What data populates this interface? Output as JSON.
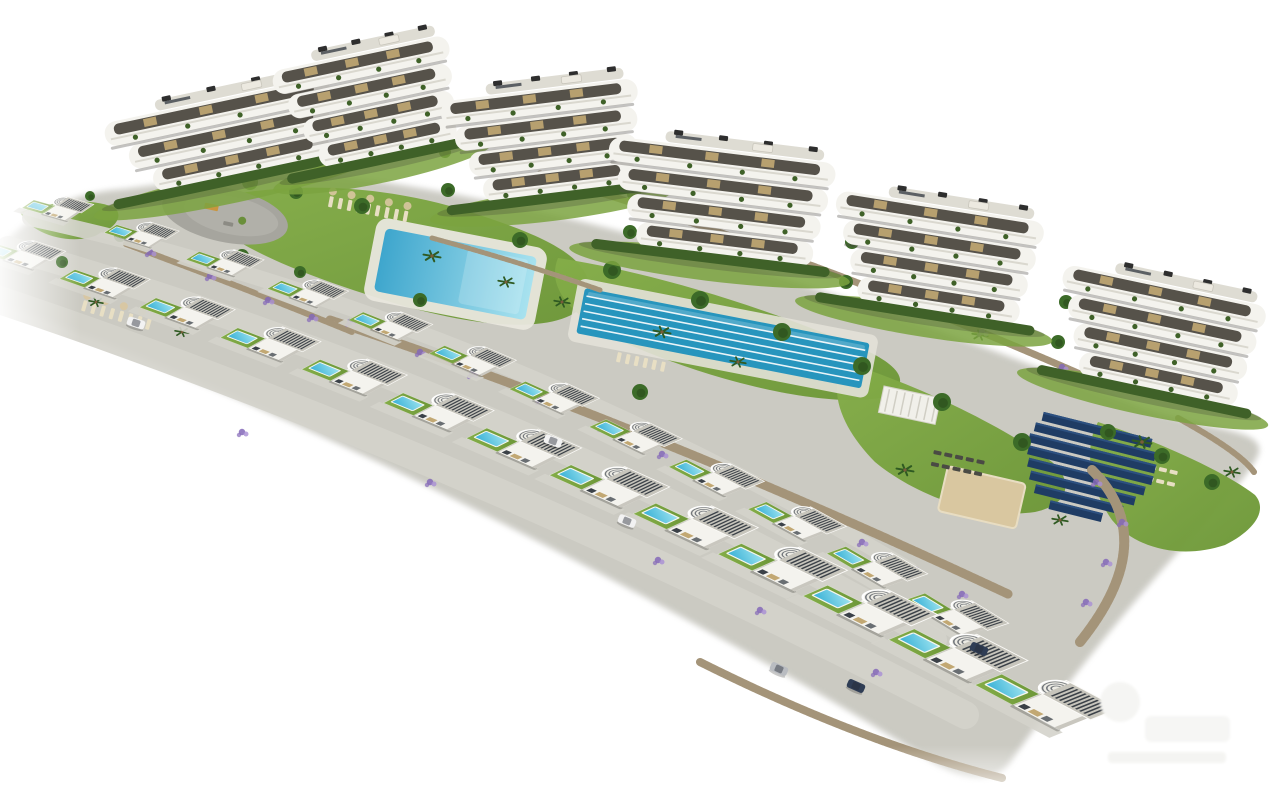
{
  "image": {
    "type": "architectural-aerial-render",
    "description": "Aerial 3D render of a hillside residential resort: six curved-balcony apartment buildings along the top, two diagonal rows of detached white villas with private pools, communal gardens, a large swimming pool, a lap pool, playground plaza, solar panel field and stone retaining walls, fading to a white background",
    "background": "#ffffff",
    "watermark_present": true
  },
  "palette": {
    "terrain": "#cbcac2",
    "terrain_dark": "#b7b6ae",
    "road": "#d4d3cb",
    "lawn": "#7ba33f",
    "lawn_dark": "#628c32",
    "hedge": "#3f6128",
    "tree": "#3c6b28",
    "palm": "#2f5a22",
    "flower": "#8468b8",
    "flower_light": "#a98fd4",
    "pool_deep": "#37b0d6",
    "pool_light": "#9fe4f0",
    "big_pool_deep": "#3ea6cd",
    "big_pool_light": "#a8e2ef",
    "lane_pool": "#2795bd",
    "white_build": "#f4f3ee",
    "interior_dark": "#56524a",
    "wood": "#c2a873",
    "slat_dark": "#3b4148",
    "roof_gray": "#c7c5bc",
    "stone": "#b3a286",
    "stone_dark": "#93836a",
    "sand": "#d9c7a0",
    "solar": "#1f3c64",
    "solar_light": "#2c5080",
    "ac_unit": "#2e2e2e",
    "car_white": "#f2f2f2",
    "car_dark": "#2f3d55",
    "car_silver": "#b9bcc1",
    "deck": "#e9e7de"
  },
  "scene": {
    "land_path": "M -10 258 C 30 212 75 193 125 190 C 230 175 320 170 395 185 C 520 205 640 235 760 272 C 900 315 1030 365 1140 408 C 1210 432 1262 430 1258 452 C 1252 472 1210 515 1165 565 C 1115 622 1060 690 1012 758 C 995 786 962 780 928 758 C 780 665 560 548 380 462 C 230 392 80 330 -10 300 Z",
    "lawns": [
      "M 195 202 C 290 178 390 186 470 212 C 555 239 598 262 588 300 C 565 338 470 328 378 298 C 295 272 215 240 195 202 Z",
      "M 558 258 C 650 272 760 305 865 350 C 905 368 912 388 880 398 C 820 408 710 380 630 345 C 575 320 545 290 558 258 Z",
      "M 845 362 C 925 388 1000 425 1052 462 C 1075 482 1068 505 1035 512 C 980 520 915 495 875 462 C 845 432 825 392 845 362 Z",
      "M 1098 422 C 1160 442 1225 472 1255 495 C 1268 510 1255 530 1225 545 C 1180 560 1135 548 1112 520 C 1092 492 1082 450 1098 422 Z",
      "M 20 212 C 55 200 95 198 115 208 C 125 218 112 232 88 238 C 60 243 30 232 20 212 Z"
    ],
    "roads": [
      {
        "d": "M 30 218 Q 480 315 910 570",
        "w": 16
      },
      {
        "d": "M 8 248 Q 475 380 935 640",
        "w": 24
      },
      {
        "d": "M -25 292 Q 455 450 965 715",
        "w": 28
      }
    ],
    "walls": [
      {
        "d": "M 330 320 Q 640 422 1008 594",
        "w": 9
      },
      {
        "d": "M 540 174 Q 800 252 1080 374",
        "w": 7
      },
      {
        "d": "M 126 244 Q 240 286 352 332",
        "w": 6
      },
      {
        "d": "M 1092 470 Q 1162 540 1080 642",
        "w": 10
      },
      {
        "d": "M 1178 418 Q 1240 452 1254 472",
        "w": 6
      },
      {
        "d": "M 700 662 Q 860 742 1002 778",
        "w": 8
      },
      {
        "d": "M 432 238 Q 520 262 600 290",
        "w": 5
      }
    ],
    "apartment_blocks": [
      {
        "x": 100,
        "y": 112,
        "w": 230,
        "floors": 3,
        "tilt": -12
      },
      {
        "x": 268,
        "y": 60,
        "w": 180,
        "floors": 4,
        "tilt": -12
      },
      {
        "x": 438,
        "y": 90,
        "w": 198,
        "floors": 4,
        "tilt": -7
      },
      {
        "x": 612,
        "y": 124,
        "w": 228,
        "floors": 4,
        "tilt": 7
      },
      {
        "x": 840,
        "y": 178,
        "w": 210,
        "floors": 4,
        "tilt": 9
      },
      {
        "x": 1068,
        "y": 252,
        "w": 207,
        "floors": 4,
        "tilt": 12
      }
    ],
    "villas_back_row": {
      "start": [
        22,
        208
      ],
      "ctrl": [
        475,
        338
      ],
      "end": [
        905,
        600
      ],
      "count": 12,
      "scale": [
        0.42,
        0.62
      ]
    },
    "villas_front_row": {
      "start": [
        -20,
        252
      ],
      "ctrl": [
        455,
        408
      ],
      "end": [
        975,
        685
      ],
      "count": 13,
      "scale": [
        0.5,
        0.85
      ]
    },
    "community_pool": {
      "x": 386,
      "y": 228,
      "rot": 11,
      "w": 154,
      "h": 64
    },
    "lap_pool": {
      "x": 585,
      "y": 288,
      "rot": 11,
      "w": 290,
      "h": 46,
      "lanes": 6
    },
    "plaza": {
      "x": 225,
      "y": 215,
      "rot": 12,
      "rx": 64,
      "ry": 27
    },
    "pergola": {
      "x": 884,
      "y": 386,
      "rot": 12,
      "w": 58,
      "h": 27
    },
    "sand_court": {
      "x": 948,
      "y": 466,
      "rot": 13,
      "w": 80,
      "h": 46
    },
    "solar_field": {
      "x": 1036,
      "y": 410,
      "rot": 14,
      "row_height": 9,
      "gap": 3,
      "offsets": [
        8,
        3,
        0,
        2,
        5,
        10,
        18,
        36
      ],
      "widths": [
        112,
        124,
        130,
        128,
        120,
        108,
        90,
        54
      ]
    },
    "lounger_groups": [
      {
        "x": 330,
        "y": 196,
        "rot": 11,
        "cols": 9,
        "rows": 1,
        "dx": 9.5,
        "dy": 14,
        "w": 4,
        "h": 11,
        "color": "#e8dfc4",
        "parasols": true
      },
      {
        "x": 84,
        "y": 300,
        "rot": 16,
        "cols": 8,
        "rows": 1,
        "dx": 9.5,
        "dy": 14,
        "w": 4,
        "h": 11,
        "color": "#e8dfc4",
        "parasols": true
      },
      {
        "x": 618,
        "y": 352,
        "rot": 12,
        "cols": 6,
        "rows": 1,
        "dx": 9,
        "dy": 12,
        "w": 4,
        "h": 10,
        "color": "#e8dfc4",
        "parasols": false
      },
      {
        "x": 934,
        "y": 450,
        "rot": 12,
        "cols": 5,
        "rows": 2,
        "dx": 11,
        "dy": 12,
        "w": 8,
        "h": 4,
        "color": "#4a4a44",
        "parasols": false
      },
      {
        "x": 1138,
        "y": 462,
        "rot": 13,
        "cols": 4,
        "rows": 2,
        "dx": 11,
        "dy": 12,
        "w": 8,
        "h": 4,
        "color": "#e8dfc4",
        "parasols": false
      }
    ],
    "trees": [
      [
        250,
        182,
        8
      ],
      [
        296,
        192,
        7
      ],
      [
        362,
        206,
        8
      ],
      [
        520,
        240,
        8
      ],
      [
        612,
        270,
        9
      ],
      [
        700,
        300,
        9
      ],
      [
        782,
        332,
        9
      ],
      [
        862,
        366,
        9
      ],
      [
        942,
        402,
        9
      ],
      [
        1022,
        442,
        9
      ],
      [
        1108,
        432,
        8
      ],
      [
        1162,
        456,
        8
      ],
      [
        1212,
        482,
        8
      ],
      [
        242,
        256,
        7
      ],
      [
        420,
        300,
        7
      ],
      [
        640,
        392,
        8
      ],
      [
        300,
        272,
        6
      ],
      [
        120,
        236,
        6
      ],
      [
        62,
        262,
        6
      ],
      [
        445,
        152,
        6
      ],
      [
        448,
        190,
        7
      ],
      [
        634,
        194,
        7
      ],
      [
        630,
        232,
        7
      ],
      [
        852,
        242,
        7
      ],
      [
        846,
        282,
        7
      ],
      [
        1066,
        302,
        7
      ],
      [
        1058,
        342,
        7
      ],
      [
        188,
        170,
        6
      ],
      [
        90,
        196,
        5
      ]
    ],
    "palms": [
      [
        432,
        256,
        1.1
      ],
      [
        506,
        282,
        1
      ],
      [
        562,
        302,
        1
      ],
      [
        662,
        332,
        1.1
      ],
      [
        738,
        362,
        1
      ],
      [
        1142,
        442,
        1.2
      ],
      [
        1232,
        472,
        1
      ],
      [
        96,
        302,
        0.9
      ],
      [
        182,
        332,
        0.9
      ],
      [
        560,
        190,
        0.9
      ],
      [
        760,
        250,
        1
      ],
      [
        980,
        335,
        1
      ],
      [
        905,
        470,
        1.1
      ],
      [
        1060,
        520,
        1
      ]
    ],
    "flowers": [
      [
        350,
        322
      ],
      [
        420,
        352
      ],
      [
        472,
        374
      ],
      [
        540,
        400
      ],
      [
        602,
        427
      ],
      [
        662,
        454
      ],
      [
        732,
        482
      ],
      [
        802,
        514
      ],
      [
        862,
        542
      ],
      [
        916,
        570
      ],
      [
        962,
        594
      ],
      [
        150,
        252
      ],
      [
        210,
        276
      ],
      [
        268,
        300
      ],
      [
        312,
        317
      ],
      [
        1096,
        482
      ],
      [
        1122,
        522
      ],
      [
        1106,
        562
      ],
      [
        1086,
        602
      ],
      [
        560,
        186
      ],
      [
        642,
        212
      ],
      [
        762,
        247
      ],
      [
        882,
        292
      ],
      [
        982,
        332
      ],
      [
        1062,
        367
      ],
      [
        242,
        432
      ],
      [
        430,
        482
      ],
      [
        658,
        560
      ],
      [
        760,
        610
      ],
      [
        876,
        672
      ]
    ],
    "cars": [
      {
        "x": 136,
        "y": 323,
        "rot": 18,
        "color": "car_white"
      },
      {
        "x": 553,
        "y": 441,
        "rot": 20,
        "color": "car_white"
      },
      {
        "x": 627,
        "y": 521,
        "rot": 22,
        "color": "car_white"
      },
      {
        "x": 779,
        "y": 669,
        "rot": 24,
        "color": "car_silver"
      },
      {
        "x": 856,
        "y": 686,
        "rot": 24,
        "color": "car_dark"
      },
      {
        "x": 979,
        "y": 649,
        "rot": 24,
        "color": "car_dark"
      }
    ],
    "watermark": {
      "x": 1100,
      "y": 688
    }
  }
}
